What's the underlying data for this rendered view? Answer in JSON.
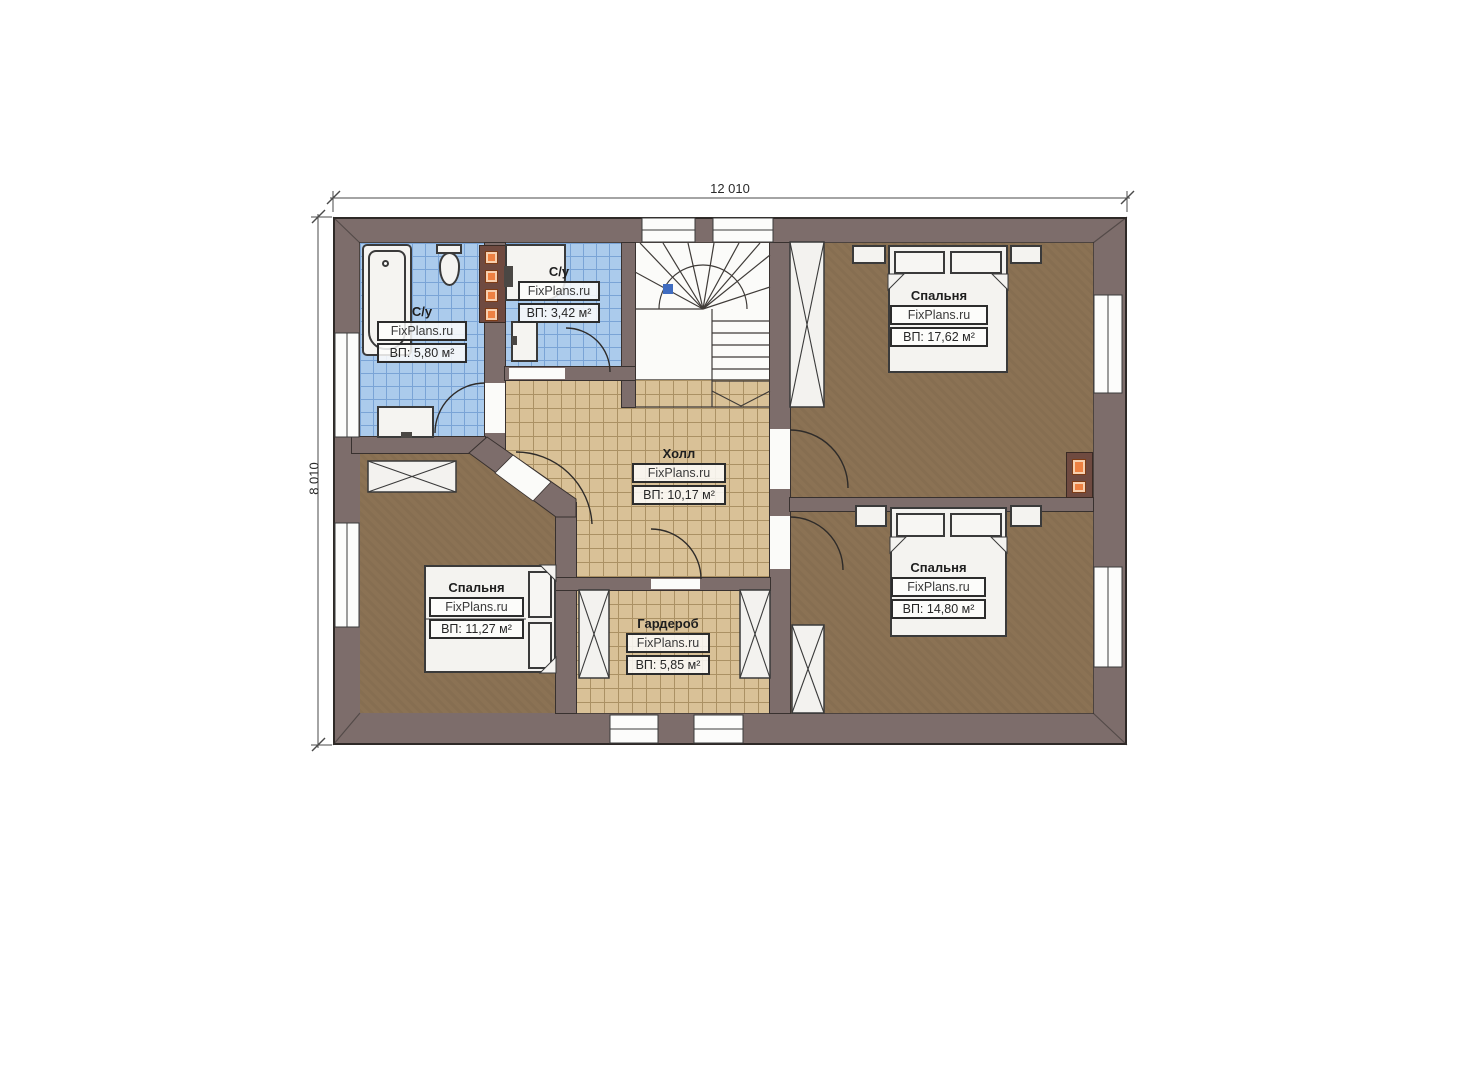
{
  "dimensions": {
    "width_label": "12 010",
    "height_label": "8 010"
  },
  "rooms": {
    "bath1": {
      "name": "С/у",
      "brand": "FixPlans.ru",
      "area": "ВП: 5,80 м²"
    },
    "bath2": {
      "name": "С/у",
      "brand": "FixPlans.ru",
      "area": "ВП: 3,42 м²"
    },
    "hall": {
      "name": "Холл",
      "brand": "FixPlans.ru",
      "area": "ВП: 10,17 м²"
    },
    "bedroom_top_right": {
      "name": "Спальня",
      "brand": "FixPlans.ru",
      "area": "ВП: 17,62 м²"
    },
    "bedroom_bottom_right": {
      "name": "Спальня",
      "brand": "FixPlans.ru",
      "area": "ВП: 14,80 м²"
    },
    "bedroom_bottom_left": {
      "name": "Спальня",
      "brand": "FixPlans.ru",
      "area": "ВП: 11,27 м²"
    },
    "wardrobe": {
      "name": "Гардероб",
      "brand": "FixPlans.ru",
      "area": "ВП: 5,85 м²"
    }
  },
  "colors": {
    "wall": "#7d6d6b",
    "wall_line": "#38312f",
    "tile_blue": "#abcbec",
    "tile_blue_grid": "#7aa4d6",
    "tile_beige": "#d9c197",
    "tile_beige_grid": "#ab9164",
    "floor_brown": "#8b7254",
    "floor_white": "#fbfbf9",
    "fixture": "#f5f4f1",
    "chimney": "#6f4a40",
    "orange": "#ee8142",
    "marker_blue": "#3f6cc0",
    "dim_text": "#2a2a2a"
  }
}
